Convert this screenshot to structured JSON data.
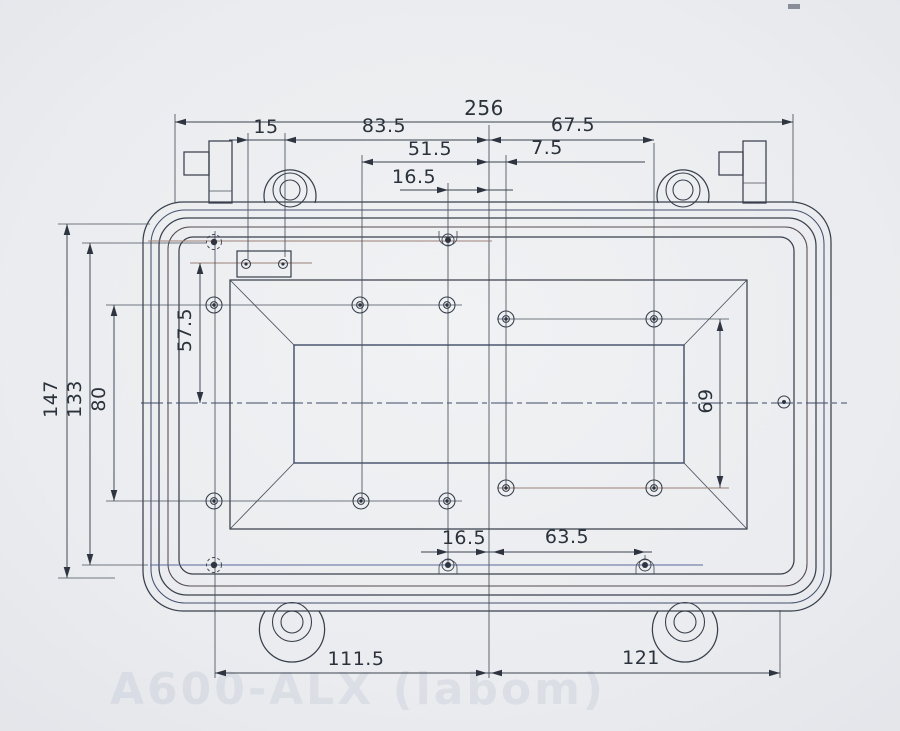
{
  "dims": {
    "overall_width": "256",
    "latch_pitch": "15",
    "left_ear_to_center": "83.5",
    "center_to_right_boss": "67.5",
    "left_boss_to_center": "51.5",
    "center_to_boss_offset": "7.5",
    "top_tab_to_center": "16.5",
    "overall_height": "147",
    "corner_hole_span": "133",
    "left_boss_span": "80",
    "block_to_centerline": "57.5",
    "right_boss_span": "69",
    "bottom_tab_to_center": "16.5",
    "center_to_bottom_tab_right": "63.5",
    "bottom_left_to_center": "111.5",
    "center_to_right_hole": "121"
  },
  "watermark_text": "A600-ALX (labom)",
  "colors": {
    "paper": "#e9ebee",
    "ink": "#39404c",
    "ink_blue": "#46506e",
    "ink_red": "#9b8078",
    "label_text": "#2b323b"
  }
}
